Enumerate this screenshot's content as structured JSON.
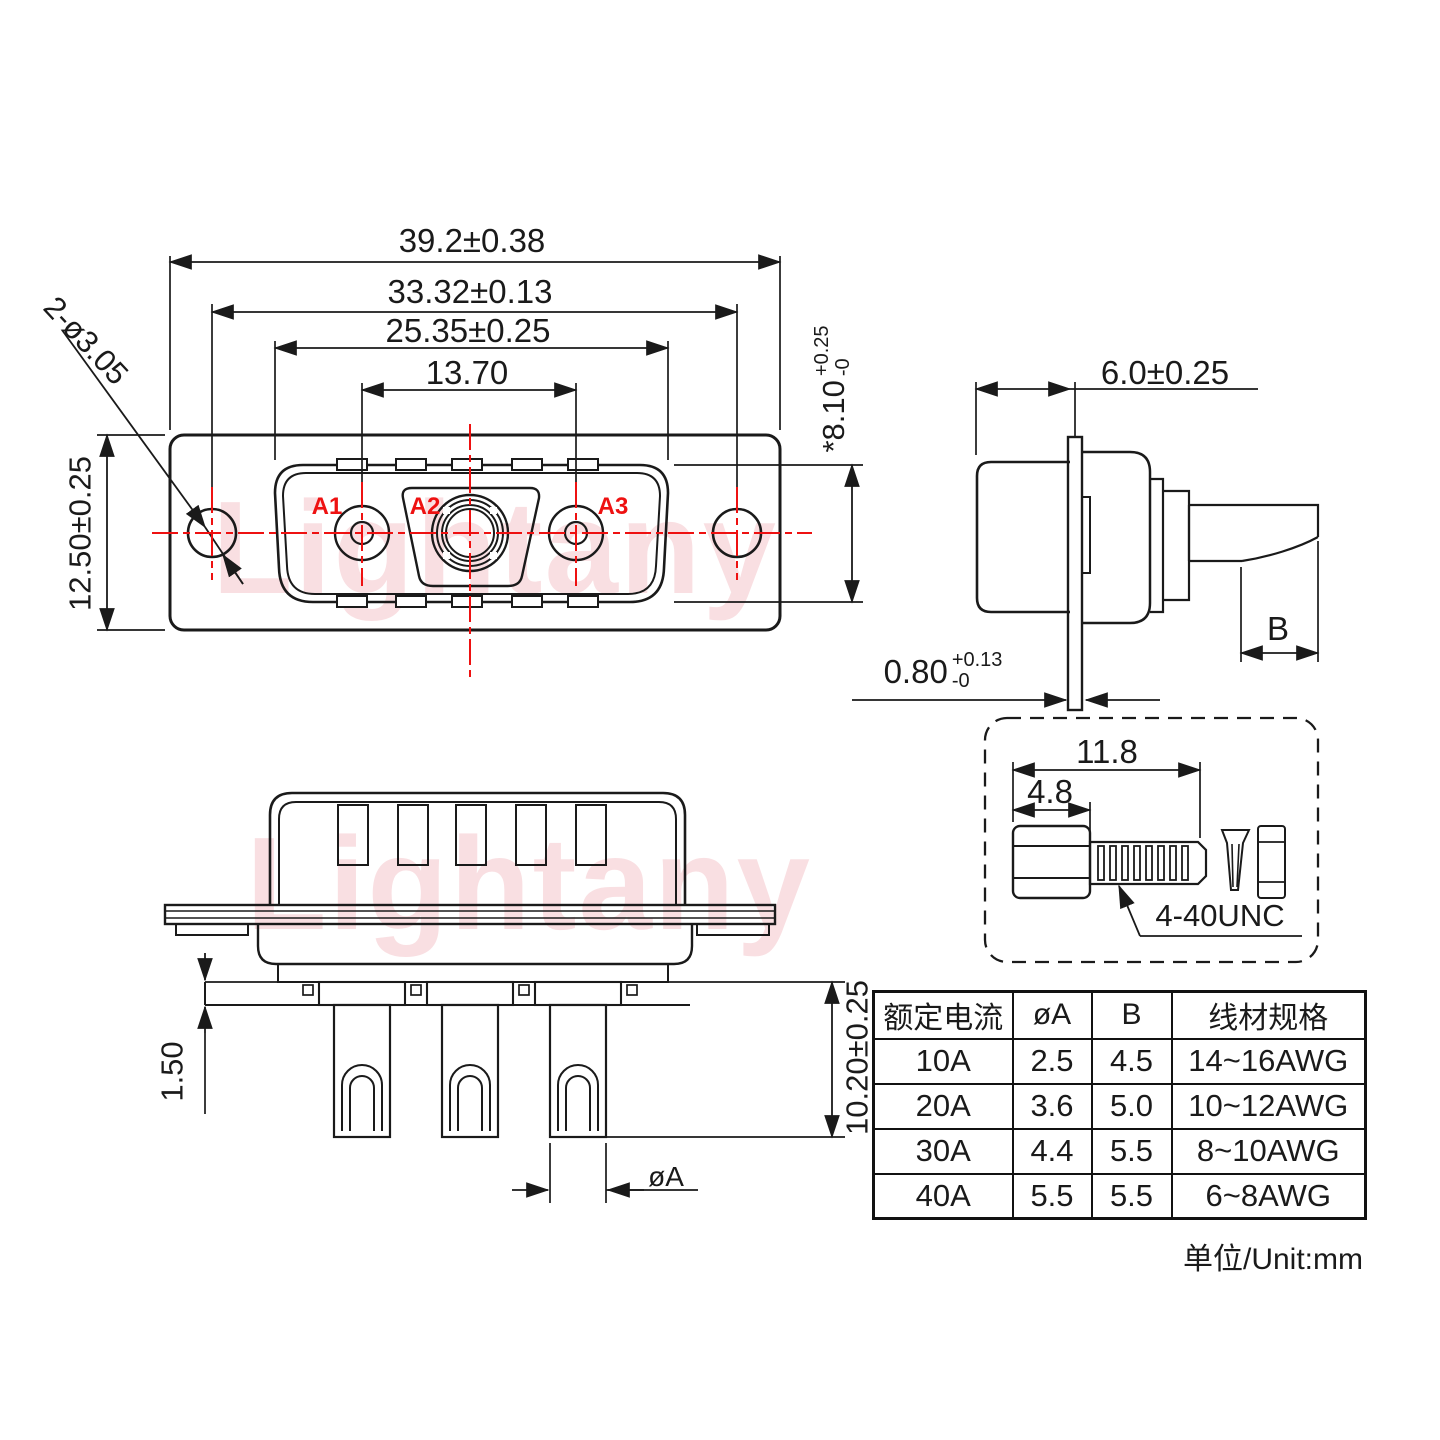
{
  "watermark": {
    "text": "Lightany",
    "color": "#f6cdd1"
  },
  "front_view": {
    "contact_labels": {
      "a1": "A1",
      "a2": "A2",
      "a3": "A3"
    },
    "dims": {
      "overall_width": "39.2±0.38",
      "hole_spacing": "33.32±0.13",
      "shell_width": "25.35±0.25",
      "contact_span": "13.70",
      "flange_height": "12.50±0.25",
      "mount_hole_callout": "2-ø3.05",
      "shell_height_value": "*8.10",
      "shell_height_tol_plus": "+0.25",
      "shell_height_tol_minus": "-0"
    }
  },
  "side_view": {
    "dims": {
      "body_depth": "6.0±0.25",
      "flange_thickness_value": "0.80",
      "flange_thickness_tol_plus": "+0.13",
      "flange_thickness_tol_minus": "-0",
      "tab_width_label": "B"
    }
  },
  "screw_detail": {
    "dims": {
      "total_length": "11.8",
      "head_length": "4.8"
    },
    "thread_label": "4-40UNC"
  },
  "bottom_view": {
    "dims": {
      "standoff_height": "1.50",
      "pin_length": "10.20±0.25",
      "pin_diameter_label": "øA"
    }
  },
  "spec_table": {
    "headers": [
      "额定电流",
      "øA",
      "B",
      "线材规格"
    ],
    "rows": [
      [
        "10A",
        "2.5",
        "4.5",
        "14~16AWG"
      ],
      [
        "20A",
        "3.6",
        "5.0",
        "10~12AWG"
      ],
      [
        "30A",
        "4.4",
        "5.5",
        "8~10AWG"
      ],
      [
        "40A",
        "5.5",
        "5.5",
        "6~8AWG"
      ]
    ]
  },
  "footer": {
    "unit_label": "单位/Unit:mm"
  },
  "colors": {
    "line": "#1a1a1a",
    "accent_red": "#ee1111",
    "watermark_pink": "#f6cdd1"
  }
}
